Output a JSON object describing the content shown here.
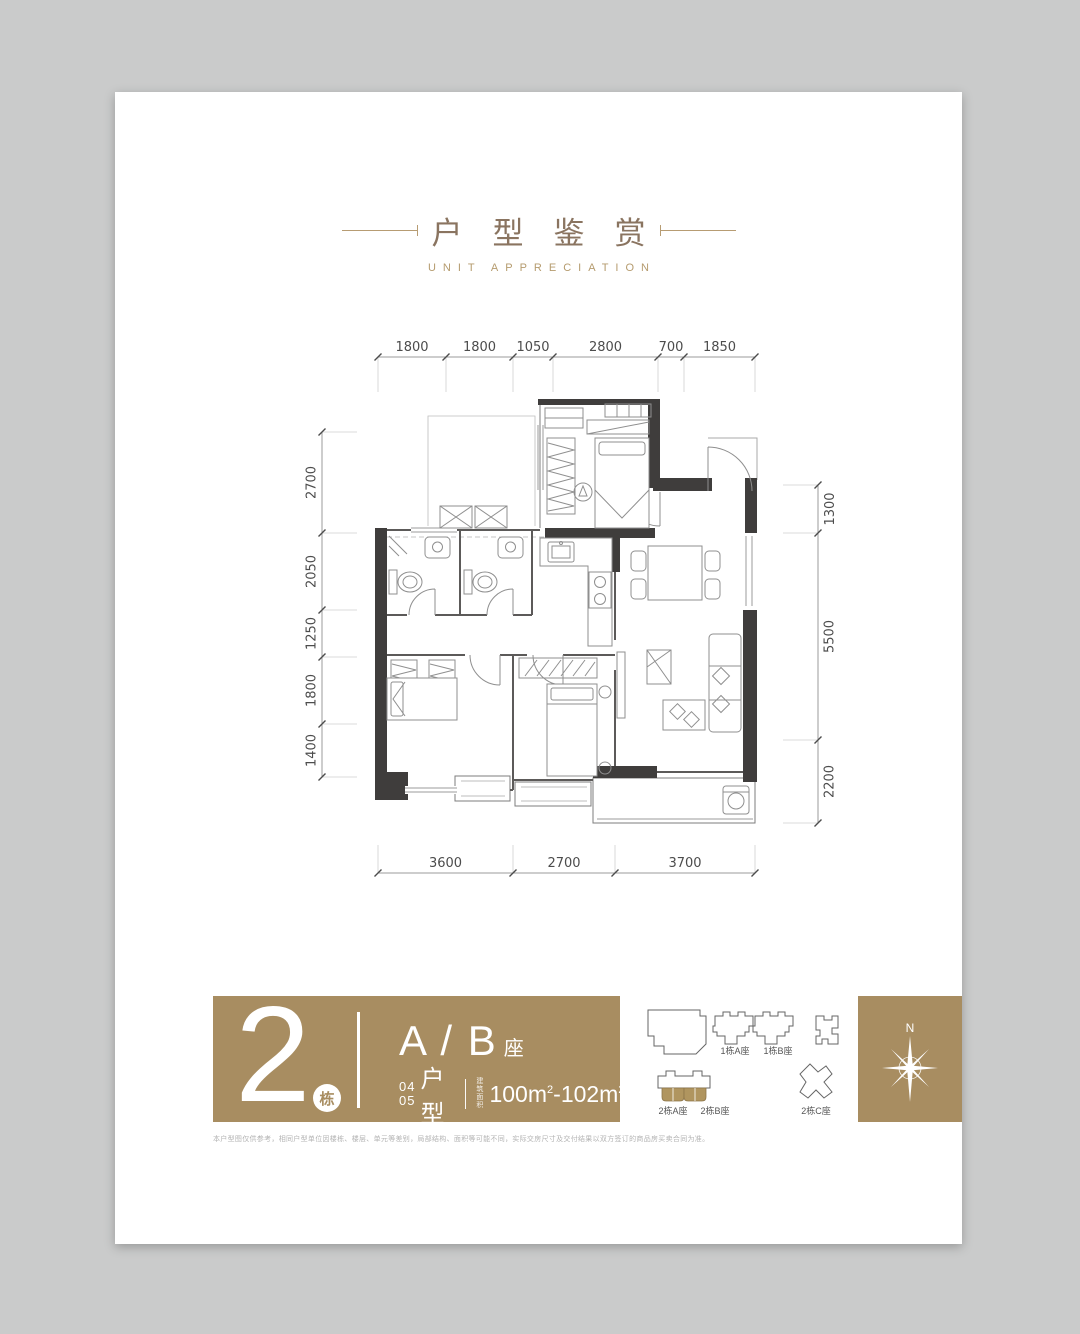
{
  "title": {
    "cn": "户型鉴赏",
    "en": "UNIT APPRECIATION"
  },
  "floorplan": {
    "dims_top": [
      "1800",
      "1800",
      "1050",
      "2800",
      "700",
      "1850"
    ],
    "dims_left": [
      "2700",
      "2050",
      "1250",
      "1800",
      "1400"
    ],
    "dims_right": [
      "1300",
      "5500",
      "2200"
    ],
    "dims_bottom": [
      "3600",
      "2700",
      "3700"
    ]
  },
  "banner": {
    "building_number": "2",
    "building_unit": "栋",
    "block": "A / B",
    "block_suffix": "座",
    "unit_top": "04",
    "unit_bottom": "05",
    "unit_label": "户型",
    "area_label": "建筑面积",
    "area": {
      "v1": "100m",
      "s1": "2",
      "sep": "-",
      "v2": "102m",
      "s2": "2"
    }
  },
  "site": {
    "labels": [
      "1栋A座",
      "1栋B座",
      "2栋A座",
      "2栋B座",
      "2栋C座"
    ],
    "compass_n": "N"
  },
  "disclaimer": "本户型图仅供参考，相同户型单位因楼栋、楼层、单元等差别，局部结构、面积等可能不同，实际交房尺寸及交付结果以双方签订的商品房买卖合同为准。",
  "colors": {
    "gold": "#a88d61",
    "gold_light": "#b59b6e",
    "title_cn": "#8a7460",
    "wall": "#3f3d3c"
  }
}
